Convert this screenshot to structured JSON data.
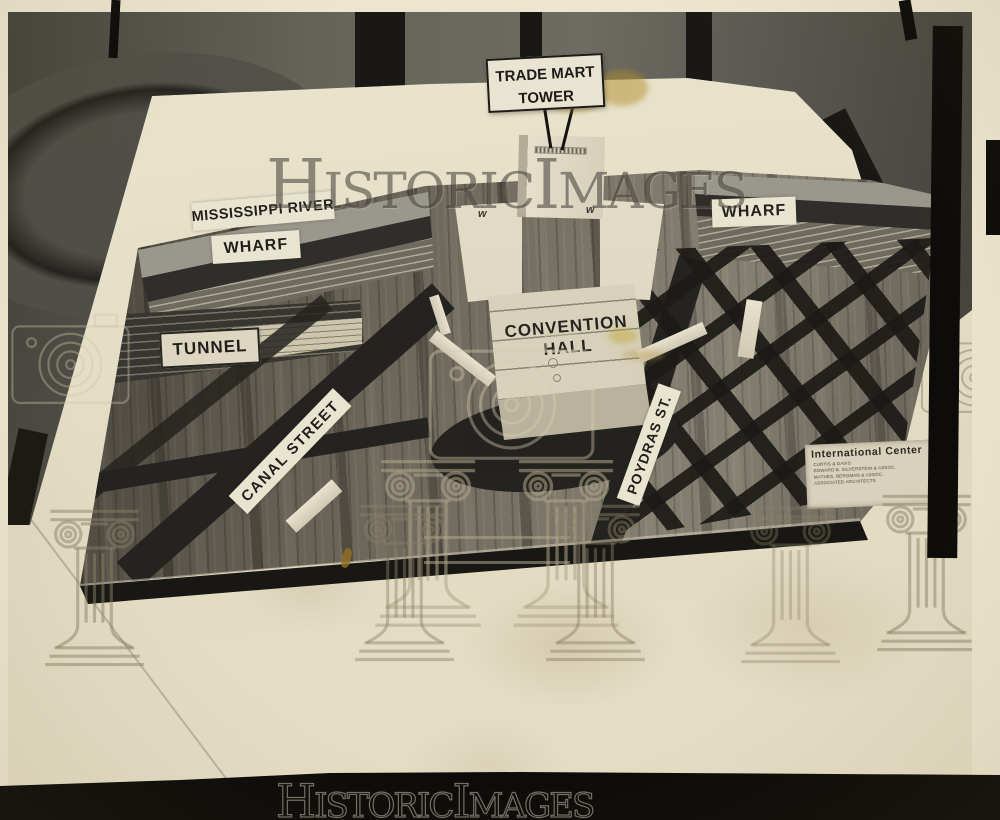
{
  "sign": {
    "line1": "TRADE MART",
    "line2": "TOWER"
  },
  "labels": {
    "mississippi_river": "MISSISSIPPI RIVER",
    "wharf_left": "WHARF",
    "wharf_right": "WHARF",
    "tunnel": "TUNNEL",
    "convention_hall_line1": "CONVENTION",
    "convention_hall_line2": "HALL",
    "canal_street": "CANAL STREET",
    "poydras_st": "POYDRAS ST."
  },
  "plaque": {
    "title": "International Center",
    "lines": [
      "CURTIS & DAVIS",
      "EDWARD B. SILVERSTEIN & ASSOC.",
      "MATHES, BERGMAN & ASSOC.",
      "ASSOCIATED ARCHITECTS"
    ]
  },
  "watermark": {
    "part1": "H",
    "part2": "ISTORIC",
    "part3": "I",
    "part4": "MAGES"
  },
  "colors": {
    "paper": "#e7e0c9",
    "board_wood": "#6f6a5e",
    "road": "#24231f",
    "stain_yellow": "#b79a3c",
    "film_black": "#0c0b09"
  }
}
